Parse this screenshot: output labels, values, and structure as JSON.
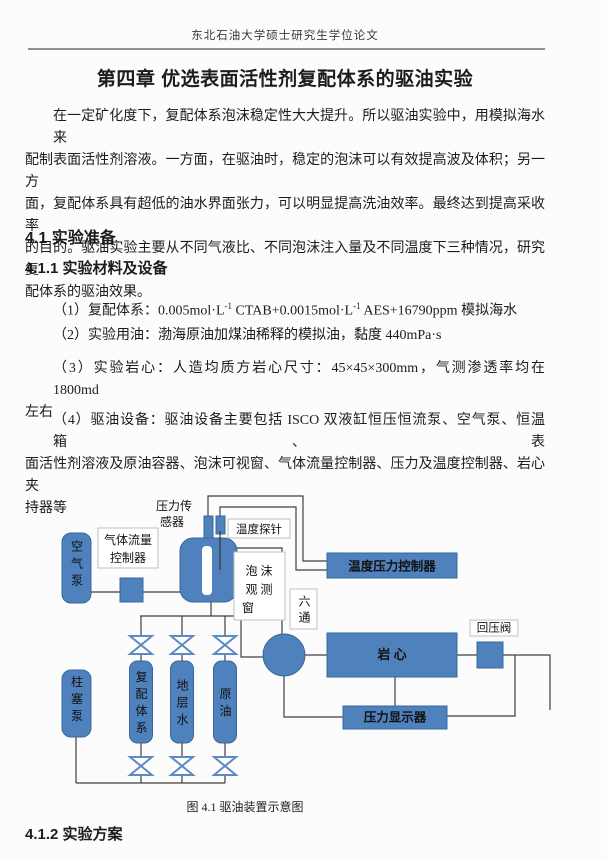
{
  "page": {
    "header": "东北石油大学硕士研究生学位论文",
    "chapter_title": "第四章 优选表面活性剂复配体系的驱油实验",
    "intro_lines": [
      "在一定矿化度下，复配体系泡沫稳定性大大提升。所以驱油实验中，用模拟海水来",
      "配制表面活性剂溶液。一方面，在驱油时，稳定的泡沫可以有效提高波及体积；另一方",
      "面，复配体系具有超低的油水界面张力，可以明显提高洗油效率。最终达到提高采收率",
      "的目的。驱油实验主要从不同气液比、不同泡沫注入量及不同温度下三种情况，研究复",
      "配体系的驱油效果。"
    ],
    "section_41": "4.1 实验准备",
    "section_411": "4.1.1 实验材料及设备",
    "item1": {
      "pre": "（1）复配体系：0.005mol·L",
      "sup1": "-1",
      "mid": " CTAB+0.0015mol·L",
      "sup2": "-1",
      "post": " AES+16790ppm 模拟海水"
    },
    "item2": "（2）实验用油：渤海原油加煤油稀释的模拟油，黏度 440mPa·s",
    "item3_lines": [
      "（3）实验岩心：人造均质方岩心尺寸：45×45×300mm，气测渗透率均在 1800md",
      "左右"
    ],
    "item4_lines": [
      "（4）驱油设备：驱油设备主要包括 ISCO 双液缸恒压恒流泵、空气泵、恒温箱、表",
      "面活性剂溶液及原油容器、泡沫可视窗、气体流量控制器、压力及温度控制器、岩心夹",
      "持器等"
    ],
    "figure_caption": "图 4.1 驱油装置示意图",
    "section_412": "4.1.2 实验方案"
  },
  "diagram": {
    "air_pump": "空气泵",
    "gas_flow_ctrl_l1": "气体流量",
    "gas_flow_ctrl_l2": "控制器",
    "pressure_sensor_l1": "压力传",
    "pressure_sensor_l2": "感器",
    "temp_probe": "温度探针",
    "foam_l1": "泡 沫",
    "foam_l2": "观 测",
    "foam_l3": "窗",
    "temp_pressure_ctrl": "温度压力控制器",
    "six_way": "六通",
    "core": "岩 心",
    "bp_valve": "回压阀",
    "pressure_display": "压力显示器",
    "tank1": "复配体系",
    "tank2": "地层水",
    "tank3": "原油",
    "plunger_pump": "柱塞泵",
    "colors": {
      "box_fill": "#4f81bd",
      "box_border": "#38679b",
      "wire": "#404040",
      "valve_stroke": "#5b8ac5",
      "label_border": "#bfbfbf"
    }
  }
}
